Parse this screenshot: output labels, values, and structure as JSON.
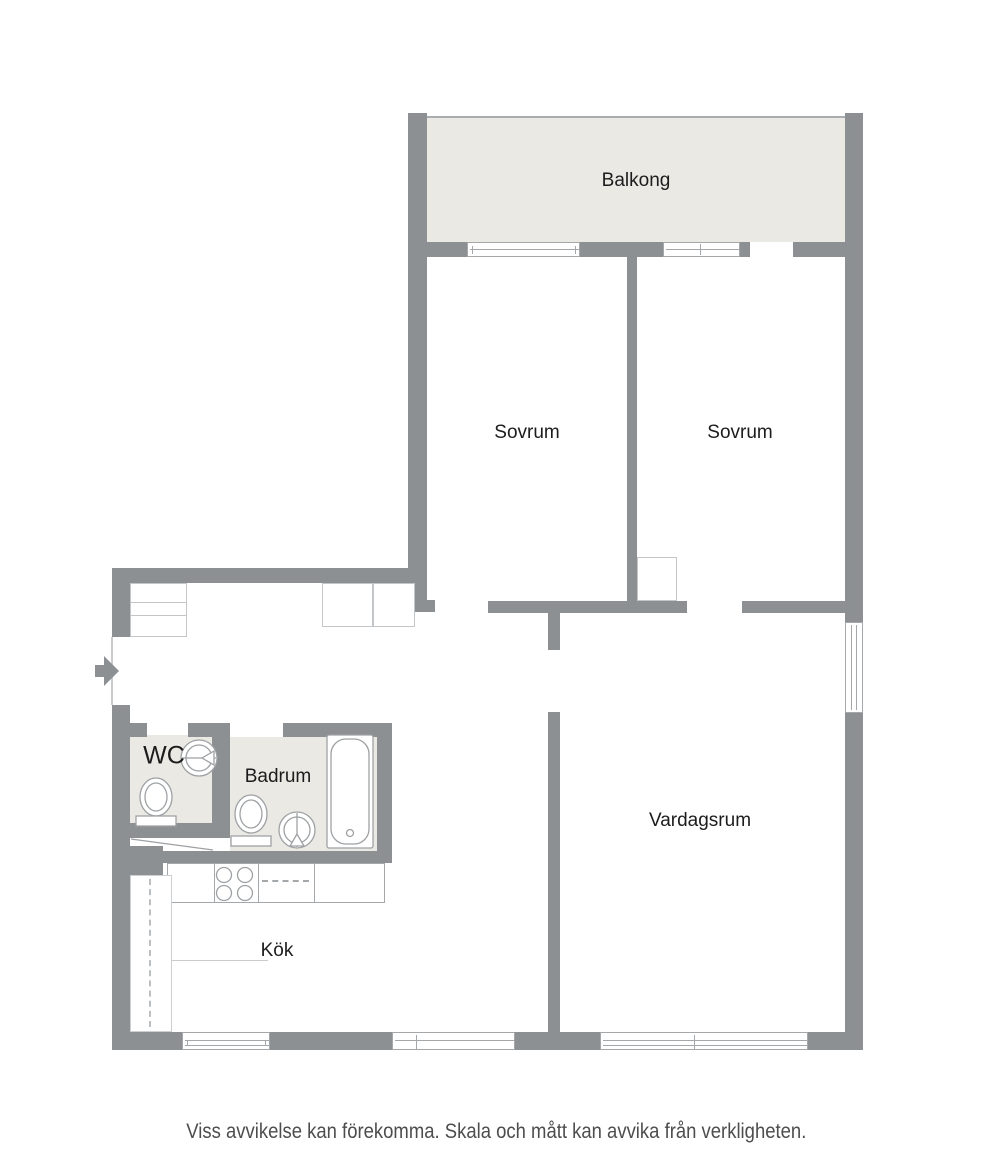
{
  "plan": {
    "type": "apartment-floor-plan",
    "rooms": {
      "balcony": {
        "label": "Balkong"
      },
      "bedroom_left": {
        "label": "Sovrum"
      },
      "bedroom_right": {
        "label": "Sovrum"
      },
      "wc": {
        "label": "WC"
      },
      "bathroom": {
        "label": "Badrum"
      },
      "living_room": {
        "label": "Vardagsrum"
      },
      "kitchen": {
        "label": "Kök"
      }
    },
    "icons": [
      "entry-arrow-icon",
      "toilet-icon",
      "sink-icon",
      "bathtub-icon",
      "stove-icon",
      "window-icon",
      "closet-icon"
    ],
    "colors": {
      "wall": "#8d9093",
      "room_fill": "#ebe9e4",
      "background": "#ffffff",
      "label_text": "#1c1c1c",
      "disclaimer_text": "#4d4d4d",
      "fixture_outline": "#9ea1a4"
    }
  },
  "disclaimer": "Viss avvikelse kan förekomma. Skala och mått kan avvika från verkligheten."
}
